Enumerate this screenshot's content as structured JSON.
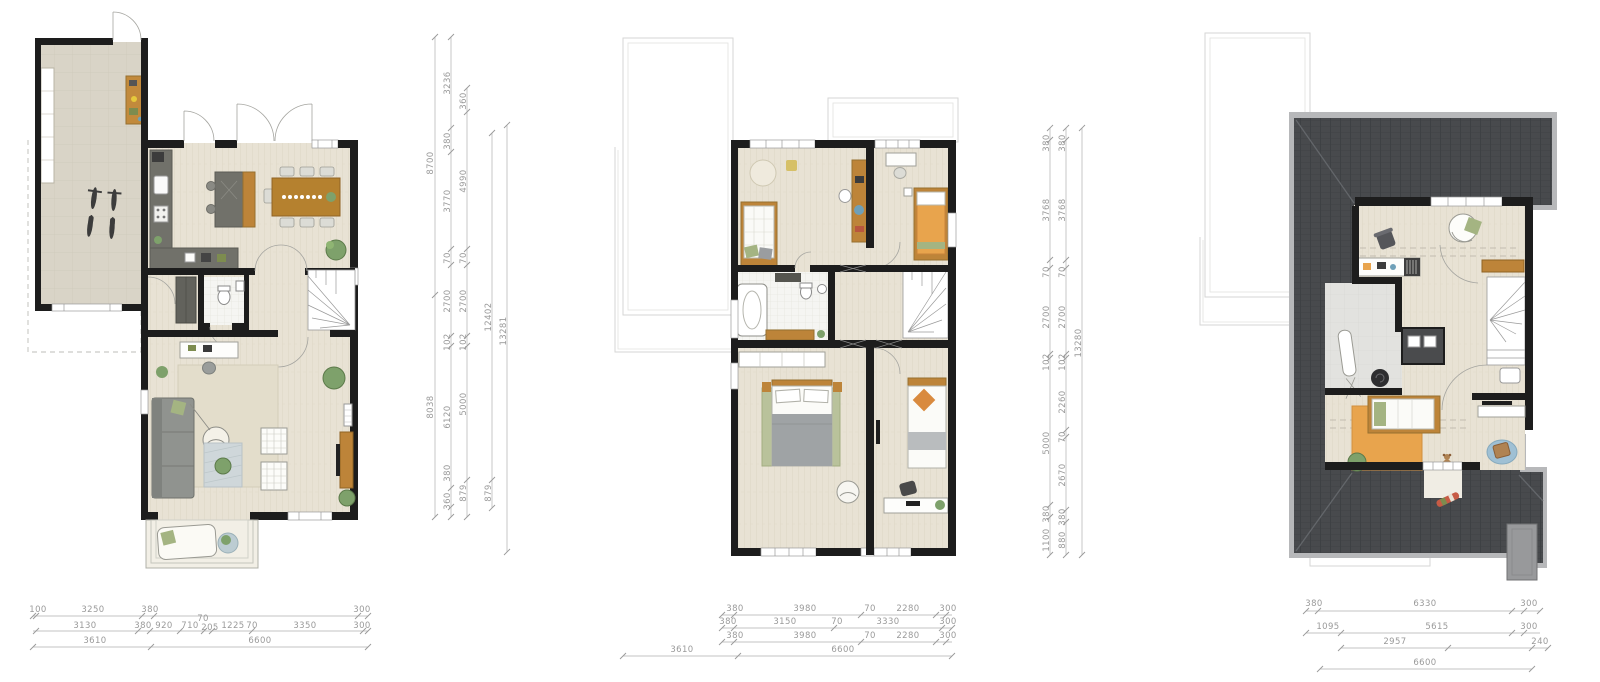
{
  "sheet": {
    "type": "floor-plan-drawing",
    "plans": [
      "ground-floor",
      "first-floor",
      "attic"
    ]
  },
  "colors": {
    "wall": "#1d1d1d",
    "wood_floor": "#e8e2d4",
    "wood_floor_stripe": "#ddd6c5",
    "garage_floor": "#d9d4c7",
    "tile_floor": "#f5f5f2",
    "laundry_floor": "#e2e2df",
    "roof_dark": "#484a4d",
    "roof_tile_line": "#36393c",
    "roof_gutter": "#b7b8ba",
    "furniture_wood": "#bd8439",
    "furniture_dark": "#6e6e66",
    "sofa_gray": "#90938f",
    "accent_green": "#a4b482",
    "plant_green": "#7ea16b",
    "accent_orange": "#e8a44d",
    "accent_blue": "#9fc0d4",
    "dim_text": "#9a9a9a",
    "ghost_line": "#d6d6d4"
  },
  "dims": {
    "ground": {
      "v1": [
        "8700",
        "8038"
      ],
      "v2": [
        "3236",
        "380",
        "3770",
        "70",
        "2700",
        "102",
        "6120",
        "380",
        "360"
      ],
      "v3": [
        "360",
        "4990",
        "70",
        "2700",
        "102",
        "5000",
        "879"
      ],
      "v4": [
        "12402",
        "879"
      ],
      "v5": [
        "13281"
      ],
      "h1": [
        "100",
        "3250",
        "380",
        "300"
      ],
      "h2": [
        "3130",
        "380",
        "920",
        "710",
        "70",
        "205",
        "1225",
        "70",
        "3350",
        "300"
      ],
      "h3": [
        "3610",
        "6600"
      ]
    },
    "first": {
      "v1": [
        "380",
        "3768",
        "70",
        "2700",
        "102",
        "5000",
        "380",
        "1100"
      ],
      "v2": [
        "380",
        "3768",
        "70",
        "2700",
        "102",
        "2260",
        "70",
        "2670",
        "380",
        "880"
      ],
      "v3": [
        "13280"
      ],
      "h1": [
        "380",
        "3980",
        "70",
        "2280",
        "300"
      ],
      "h2": [
        "380",
        "3150",
        "70",
        "3330",
        "300"
      ],
      "h3": [
        "380",
        "3980",
        "70",
        "2280",
        "300"
      ],
      "h4": [
        "3610",
        "6600"
      ]
    },
    "attic": {
      "h1": [
        "380",
        "6330",
        "300"
      ],
      "h2": [
        "1095",
        "5615",
        "300"
      ],
      "h3": [
        "2957",
        "240"
      ],
      "h4": [
        "6600"
      ]
    }
  }
}
